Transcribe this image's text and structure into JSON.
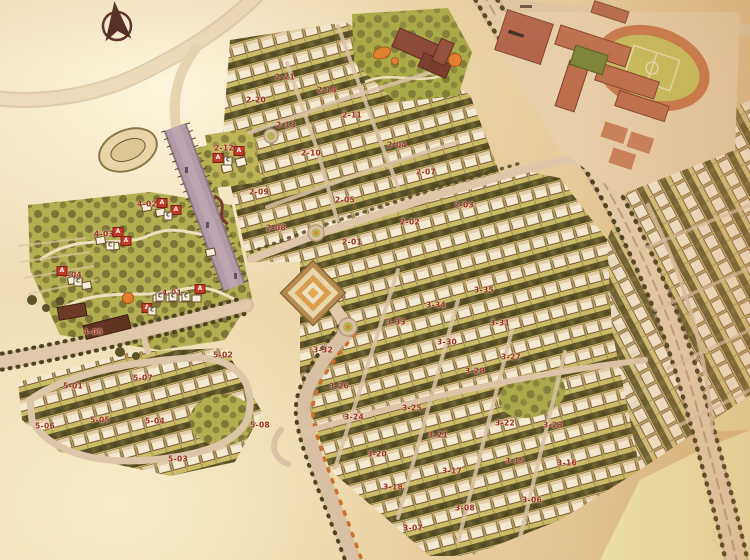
{
  "map": {
    "compass_icon": "north-arrow",
    "unit_markers": {
      "a": "A",
      "c": "C"
    },
    "block_labels": [
      "2-21",
      "2-14",
      "2-20",
      "2-13",
      "2-11",
      "2-10",
      "2-12",
      "2-04",
      "2-07",
      "2-09",
      "2-05",
      "2-03",
      "2-02",
      "2-08",
      "2-01",
      "3-35",
      "3-34",
      "3-33",
      "3-31",
      "3-30",
      "3-32",
      "3-27",
      "3-28",
      "3-26",
      "3-25",
      "3-24",
      "3-22",
      "3-23",
      "3-21",
      "3-20",
      "3-15",
      "3-16",
      "3-17",
      "3-18",
      "3-06",
      "3-08",
      "3-07",
      "4-02",
      "4-03",
      "4-04",
      "4-01",
      "4-05",
      "5-02",
      "5-07",
      "5-01",
      "5-05",
      "5-04",
      "5-06",
      "5-08",
      "5-03"
    ],
    "palette": {
      "parchment": "#ecd9ac",
      "road": "#e3cfae",
      "canal": "#b29aa6",
      "lawn_green": "#b2ae52",
      "tree_green": "#5d5528",
      "school_terracotta": "#b5674a",
      "clubhouse_brown": "#8a4836",
      "track_orange": "#c8784a",
      "accent_orange": "#e08030",
      "label_red": "#9c2d22",
      "marker_red": "#c23b2a"
    }
  }
}
